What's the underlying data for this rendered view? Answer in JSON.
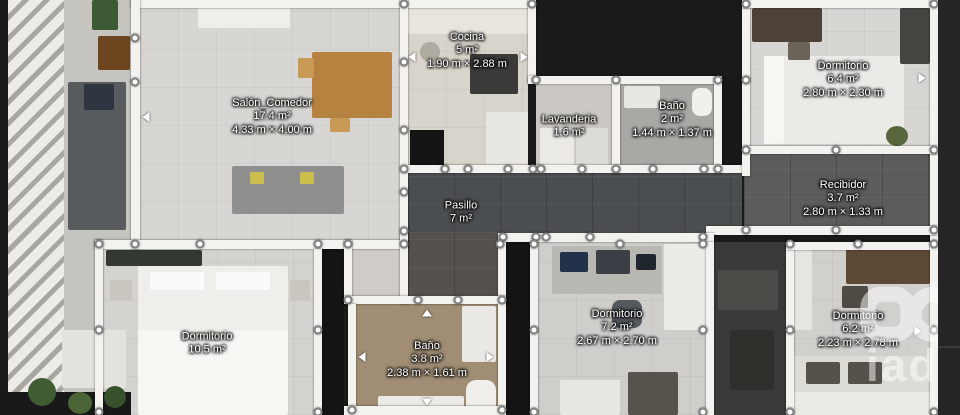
{
  "rooms": [
    {
      "name": "Salón_Comedor",
      "area": "17.4 m²",
      "dims": "4.33 m × 4.00 m"
    },
    {
      "name": "Cocina",
      "area": "5 m²",
      "dims": "1.90 m × 2.88 m"
    },
    {
      "name": "Lavanderia",
      "area": "1.6 m²"
    },
    {
      "name": "Baño",
      "area": "2 m²",
      "dims": "1.44 m × 1.37 m"
    },
    {
      "name": "Dormitorio",
      "area": "6.4 m²",
      "dims": "2.80 m × 2.30 m"
    },
    {
      "name": "Recibidor",
      "area": "3.7 m²",
      "dims": "2.80 m × 1.33 m"
    },
    {
      "name": "Pasillo",
      "area": "7 m²"
    },
    {
      "name": "Dormitorio",
      "area": "10.5 m²"
    },
    {
      "name": "Baño",
      "area": "3.8 m²",
      "dims": "2.38 m × 1.61 m"
    },
    {
      "name": "Dormitorio",
      "area": "7.2 m²",
      "dims": "2.67 m × 2.70 m"
    },
    {
      "name": "Dormitorio",
      "area": "6.2 m²",
      "dims": "2.23 m × 2.78 m"
    }
  ],
  "watermark": {
    "logo_text": "iad"
  },
  "colors": {
    "background": "#1b1b1b",
    "wall": "#f3f2ef",
    "corridor_floor": "#4b4e50",
    "room_floor_light": "#d6d4d0",
    "label_text": "#ffffff"
  }
}
